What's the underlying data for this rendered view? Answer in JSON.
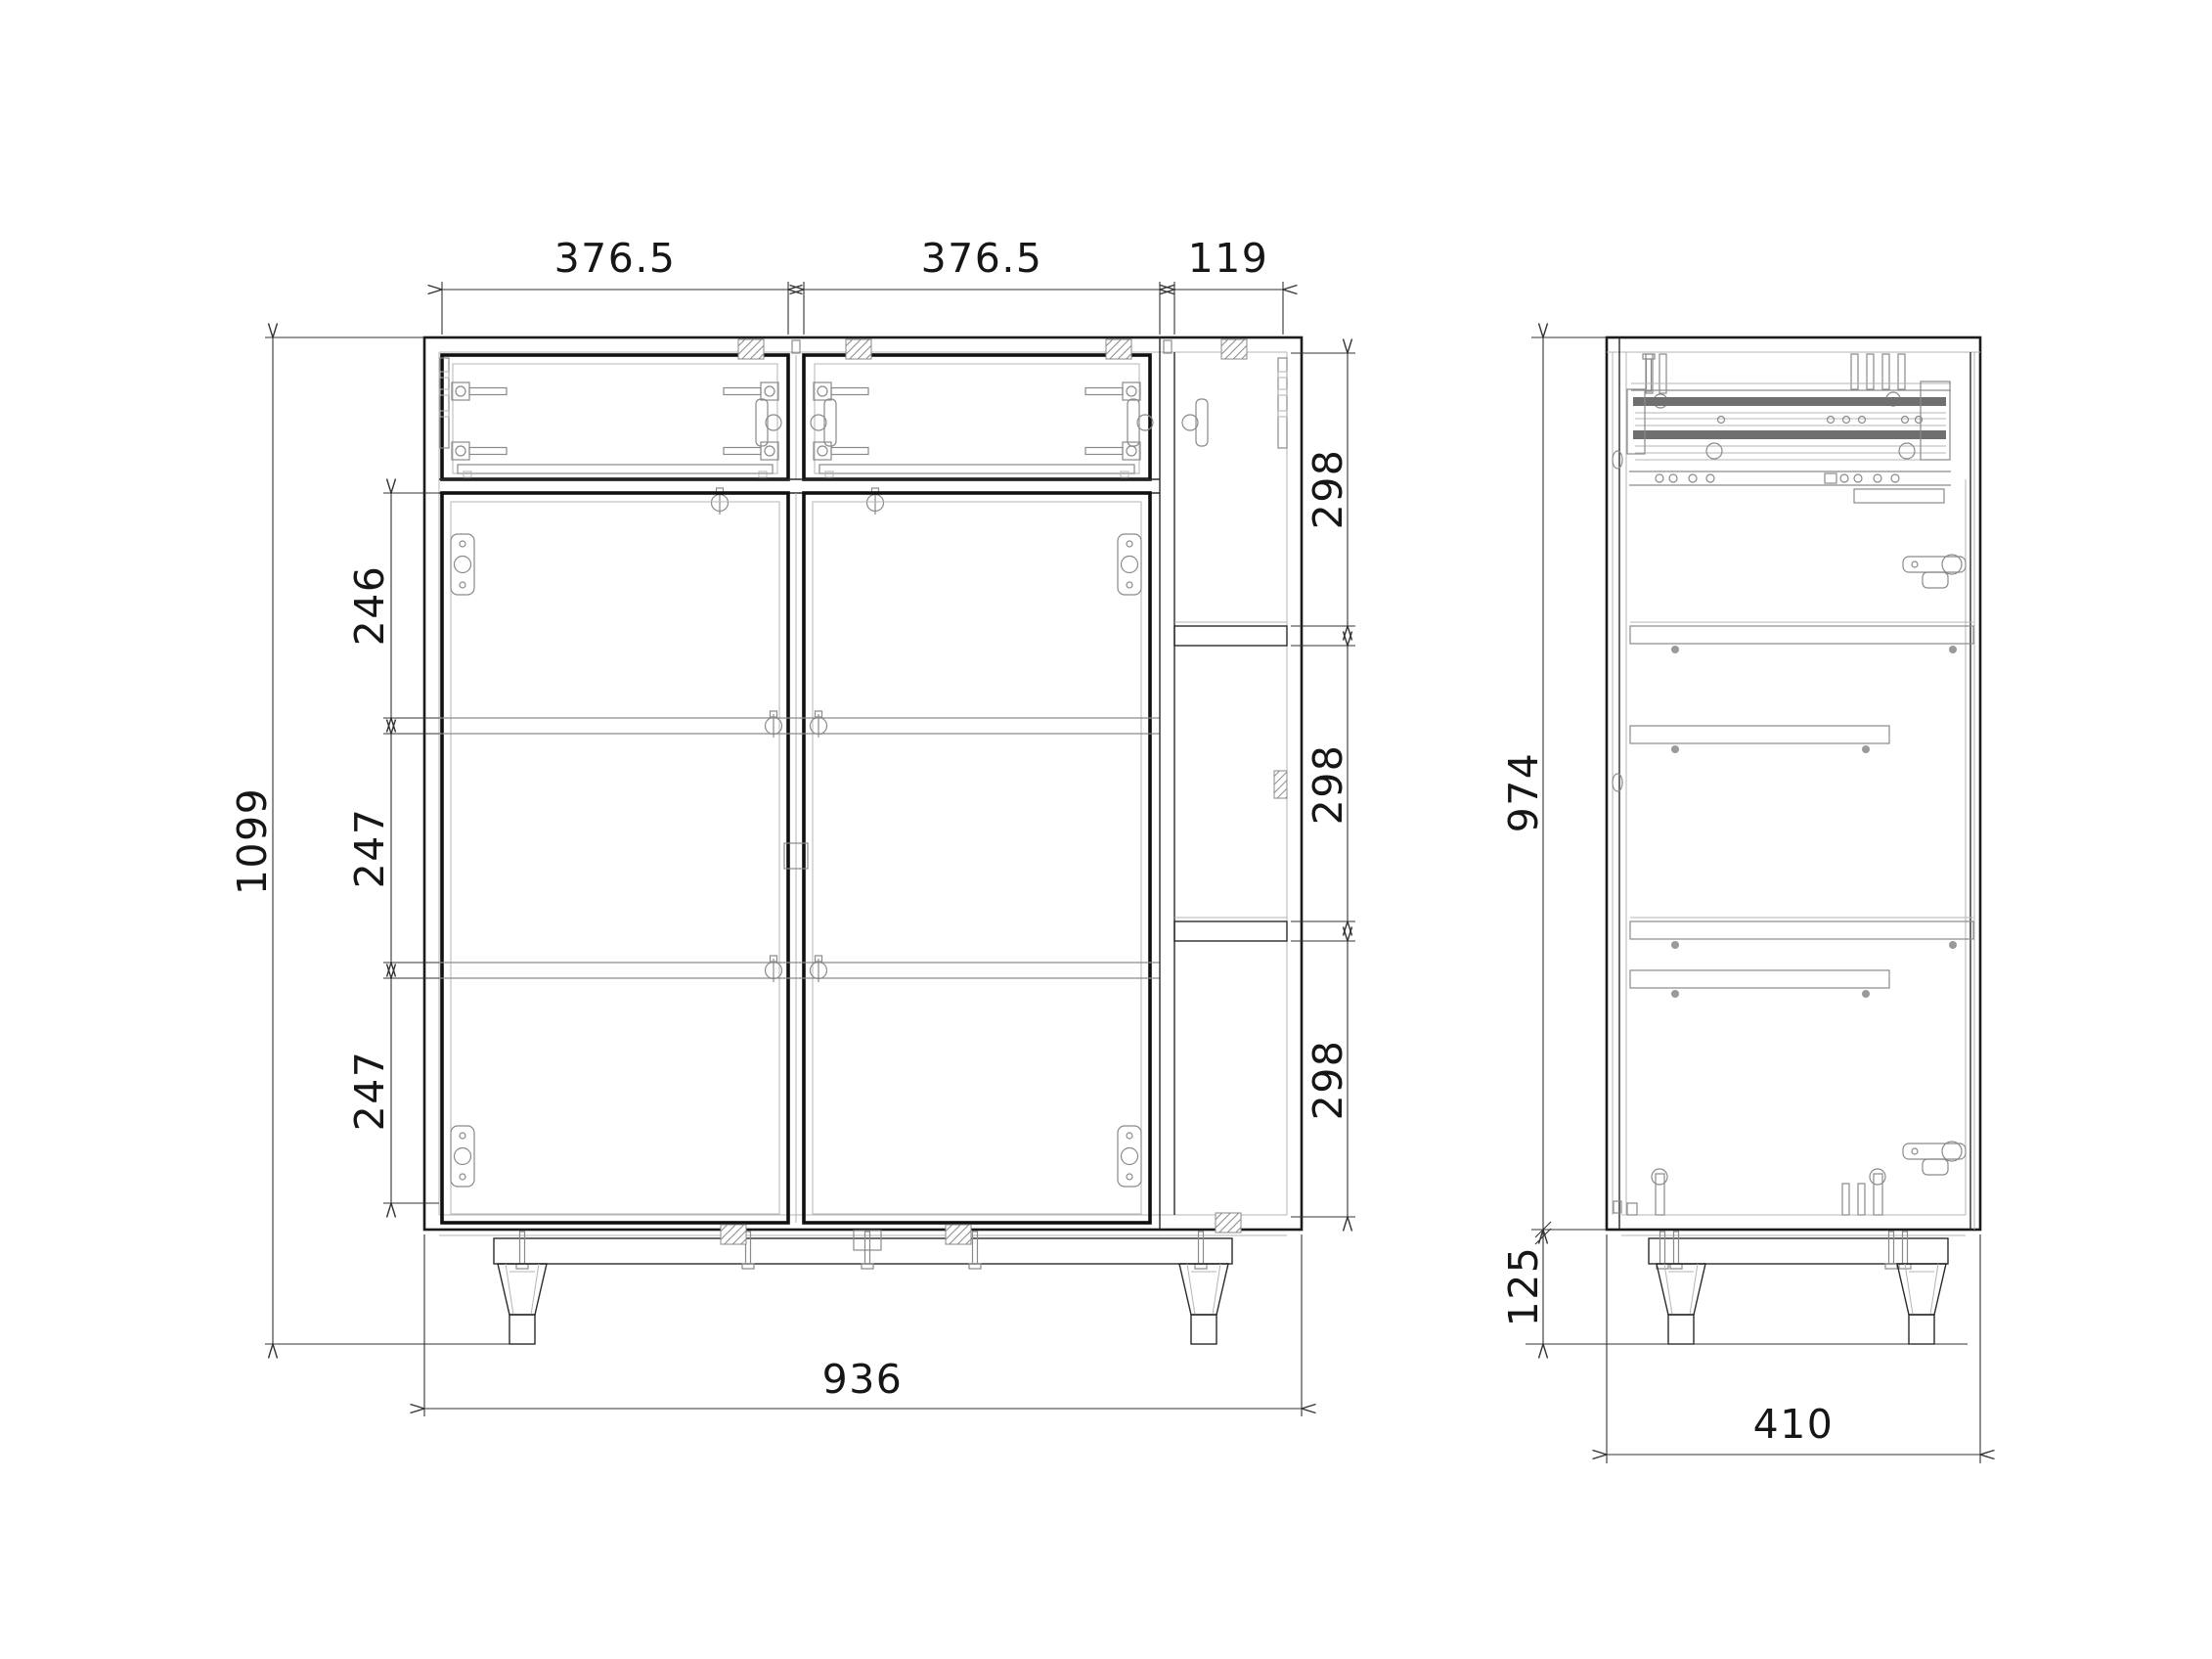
{
  "front_view": {
    "top_dims": [
      "376.5",
      "376.5",
      "119"
    ],
    "overall_height": "1099",
    "shelf_gap_dims": [
      "246",
      "247",
      "247"
    ],
    "right_compartment_dims": [
      "298",
      "298",
      "298"
    ],
    "overall_width": "936"
  },
  "side_view": {
    "carcass_height": "974",
    "leg_height": "125",
    "depth": "410"
  },
  "colors": {
    "line_black": "#1b1b1b",
    "hardware_gray": "#8a8a8a",
    "background": "#ffffff"
  }
}
